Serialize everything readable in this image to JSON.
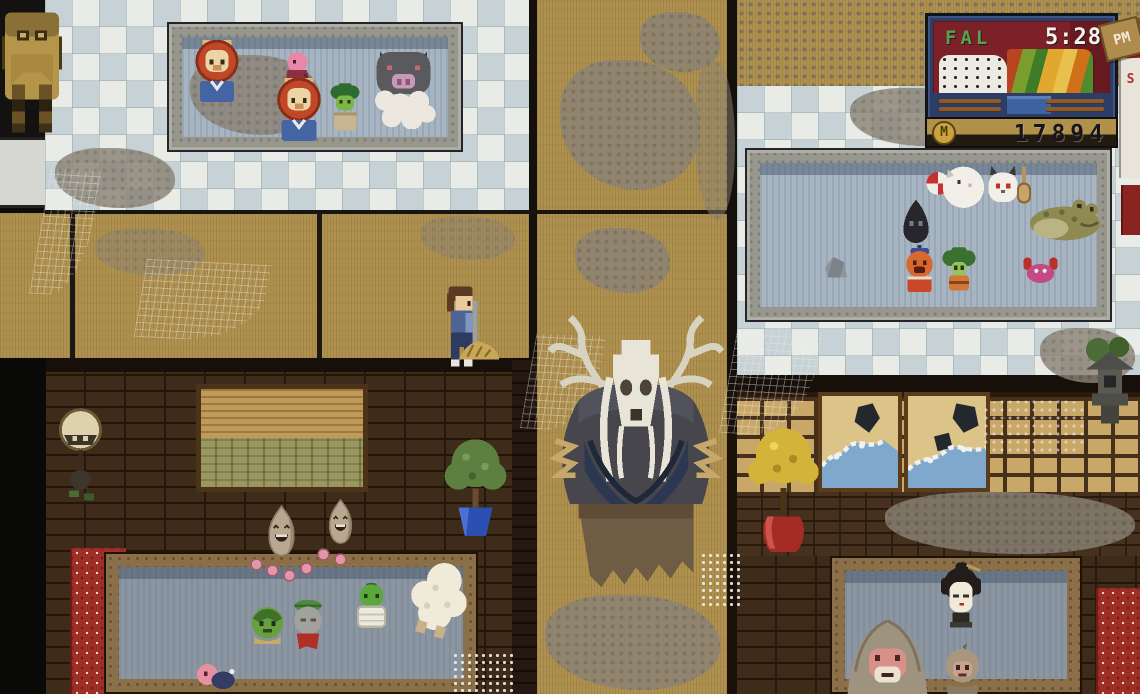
{
  "hud": {
    "season_label": "FAL",
    "time_value": "5:28",
    "meridiem_label": "PM",
    "money_value": "17894",
    "currency_symbol": "M",
    "calendar_letter": "S",
    "colors": {
      "panel_frame": "#2c3e66",
      "panel_bg": "#7c2127",
      "season_text": "#55a34c",
      "time_text": "#f4f4f0",
      "money_text": "#16141e",
      "coin": "#c9a43a",
      "tag_wood": "#b08b4e"
    }
  },
  "palette": {
    "tile_white": "#e9ebe7",
    "tile_blue": "#c6d2d5",
    "tatami": "#b09250",
    "dust": "#8b8376",
    "wood_dark": "#3e2b1a",
    "brick": "#46311f",
    "water_light": "#a7b4c1",
    "water_dark": "#8c96a2",
    "stone_frame": "#97978e",
    "wood_frame": "#8a6f48",
    "tapestry_red": "#9e2f26",
    "outside_black": "#0d0c0a"
  },
  "sprites": [
    {
      "type": "lion-spirit",
      "name": "lion-spirit-bather-left",
      "kind": "creature",
      "x": 194,
      "y": 40,
      "w": 46,
      "h": 63
    },
    {
      "type": "pink-bird",
      "name": "pink-bird-spirit",
      "kind": "creature",
      "x": 280,
      "y": 50,
      "w": 35,
      "h": 44
    },
    {
      "type": "lion-spirit",
      "name": "lion-spirit-bather-center",
      "kind": "creature",
      "x": 275,
      "y": 78,
      "w": 48,
      "h": 64
    },
    {
      "type": "broccoli-frog",
      "name": "broccoli-frog-spirit",
      "kind": "creature",
      "x": 327,
      "y": 83,
      "w": 36,
      "h": 50
    },
    {
      "type": "boar-spirit",
      "name": "grey-boar-spirit",
      "kind": "creature",
      "x": 370,
      "y": 42,
      "w": 67,
      "h": 87
    },
    {
      "type": "cat-fan",
      "name": "white-cat-with-fan",
      "kind": "creature",
      "x": 926,
      "y": 160,
      "w": 62,
      "h": 52
    },
    {
      "type": "ghost-cat",
      "name": "white-eared-spirit",
      "kind": "creature",
      "x": 984,
      "y": 163,
      "w": 38,
      "h": 43
    },
    {
      "type": "paddle",
      "name": "wooden-paddle",
      "kind": "prop",
      "x": 1016,
      "y": 166,
      "w": 16,
      "h": 38
    },
    {
      "type": "shadow-blob",
      "name": "shadow-spirit",
      "kind": "creature",
      "x": 898,
      "y": 198,
      "w": 36,
      "h": 45
    },
    {
      "type": "toad",
      "name": "giant-toad-spirit",
      "kind": "creature",
      "x": 1027,
      "y": 194,
      "w": 76,
      "h": 47
    },
    {
      "type": "orange-kid",
      "name": "orange-capped-spirit",
      "kind": "creature",
      "x": 900,
      "y": 245,
      "w": 39,
      "h": 47
    },
    {
      "type": "broccoli-kid",
      "name": "broccoli-headed-spirit",
      "kind": "creature",
      "x": 940,
      "y": 247,
      "w": 38,
      "h": 44
    },
    {
      "type": "crab",
      "name": "pink-crab-spirit",
      "kind": "creature",
      "x": 1022,
      "y": 255,
      "w": 37,
      "h": 29
    },
    {
      "type": "rock",
      "name": "bath-rock",
      "kind": "prop",
      "x": 822,
      "y": 254,
      "w": 28,
      "h": 25
    },
    {
      "type": "spirit-face",
      "name": "laughing-spirit-face-left",
      "kind": "creature",
      "x": 265,
      "y": 504,
      "w": 33,
      "h": 54
    },
    {
      "type": "spirit-face",
      "name": "laughing-spirit-face-right",
      "kind": "creature",
      "x": 324,
      "y": 498,
      "w": 33,
      "h": 47
    },
    {
      "type": "orb",
      "name": "pink-orb",
      "kind": "prop",
      "x": 250,
      "y": 558,
      "w": 13,
      "h": 13
    },
    {
      "type": "orb",
      "name": "pink-orb",
      "kind": "prop",
      "x": 266,
      "y": 564,
      "w": 13,
      "h": 13
    },
    {
      "type": "orb",
      "name": "pink-orb",
      "kind": "prop",
      "x": 283,
      "y": 569,
      "w": 13,
      "h": 13
    },
    {
      "type": "orb",
      "name": "pink-orb",
      "kind": "prop",
      "x": 300,
      "y": 562,
      "w": 13,
      "h": 13
    },
    {
      "type": "orb",
      "name": "pink-orb",
      "kind": "prop",
      "x": 317,
      "y": 548,
      "w": 13,
      "h": 13
    },
    {
      "type": "orb",
      "name": "pink-orb",
      "kind": "prop",
      "x": 334,
      "y": 553,
      "w": 13,
      "h": 13
    },
    {
      "type": "kappa",
      "name": "kappa-spirit",
      "kind": "creature",
      "x": 245,
      "y": 606,
      "w": 45,
      "h": 42
    },
    {
      "type": "jizo",
      "name": "jizo-statue-spirit",
      "kind": "creature",
      "x": 287,
      "y": 598,
      "w": 42,
      "h": 53
    },
    {
      "type": "frog-tub",
      "name": "frog-in-tub",
      "kind": "creature",
      "x": 350,
      "y": 583,
      "w": 43,
      "h": 46
    },
    {
      "type": "sheep",
      "name": "white-fluffy-spirit",
      "kind": "creature",
      "x": 410,
      "y": 560,
      "w": 58,
      "h": 78,
      "r": 16
    },
    {
      "type": "pink-swimmer",
      "name": "pink-swimming-spirit",
      "kind": "creature",
      "x": 194,
      "y": 660,
      "w": 42,
      "h": 32
    },
    {
      "type": "geisha",
      "name": "geisha-spirit-head",
      "kind": "creature",
      "x": 936,
      "y": 562,
      "w": 50,
      "h": 84
    },
    {
      "type": "monkey-large",
      "name": "snow-monkey-large",
      "kind": "creature",
      "x": 841,
      "y": 616,
      "w": 93,
      "h": 80
    },
    {
      "type": "monkey-small",
      "name": "snow-monkey-small",
      "kind": "creature",
      "x": 940,
      "y": 643,
      "w": 45,
      "h": 52
    },
    {
      "type": "player",
      "name": "player-character-sweeping",
      "kind": "creature",
      "x": 441,
      "y": 286,
      "w": 39,
      "h": 81
    },
    {
      "type": "straw-pile",
      "name": "swept-dust-pile",
      "kind": "prop",
      "x": 456,
      "y": 336,
      "w": 46,
      "h": 27
    },
    {
      "type": "deer-spirit",
      "name": "deer-skull-spirit",
      "kind": "creature",
      "x": 544,
      "y": 314,
      "w": 184,
      "h": 288
    },
    {
      "type": "backpack",
      "name": "backpack",
      "kind": "prop",
      "x": 2,
      "y": 6,
      "w": 60,
      "h": 127
    },
    {
      "type": "plant-blue",
      "name": "potted-tree-blue-pot",
      "kind": "prop",
      "x": 444,
      "y": 438,
      "w": 63,
      "h": 101
    },
    {
      "type": "yellow-tree",
      "name": "yellow-tree-red-pot",
      "kind": "prop",
      "x": 748,
      "y": 427,
      "w": 71,
      "h": 128
    },
    {
      "type": "gong",
      "name": "hanging-gong-ornament",
      "kind": "prop",
      "x": 57,
      "y": 408,
      "w": 47,
      "h": 97
    },
    {
      "type": "lantern",
      "name": "stone-lantern",
      "kind": "prop",
      "x": 1080,
      "y": 336,
      "w": 60,
      "h": 94
    }
  ]
}
